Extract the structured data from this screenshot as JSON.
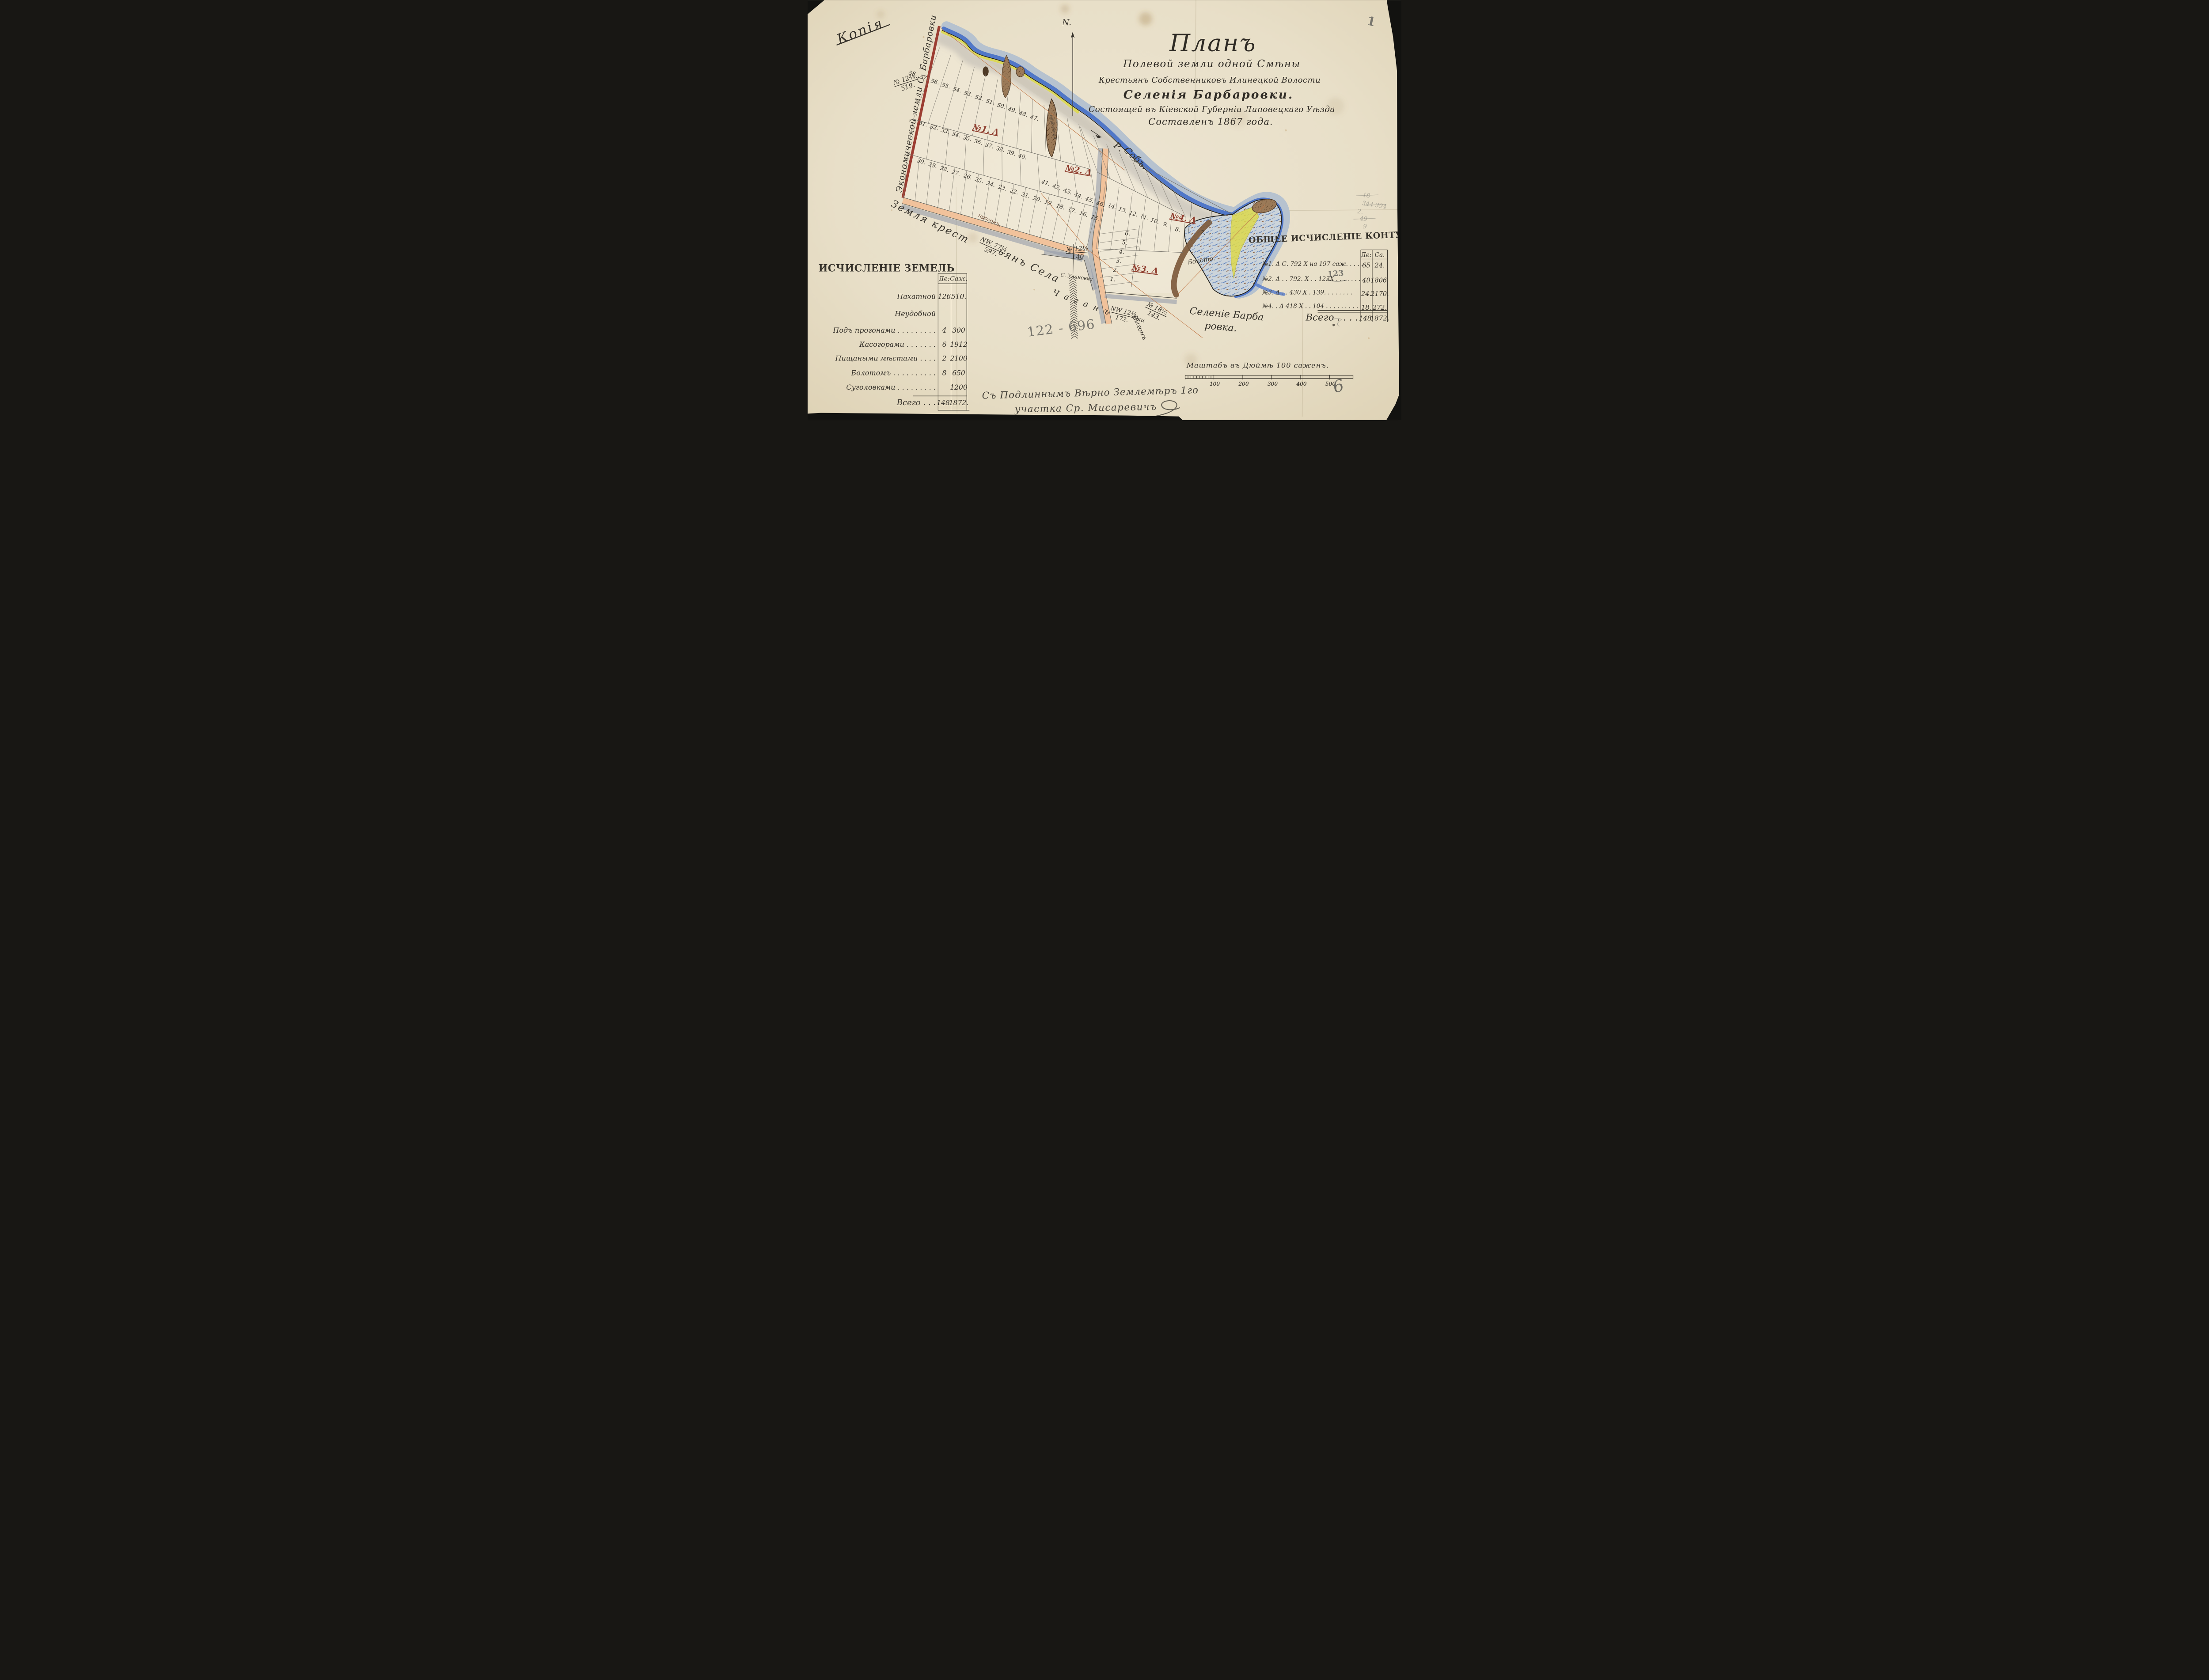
{
  "page": {
    "number": "1"
  },
  "stamp": {
    "copy": "Копія"
  },
  "compass": {
    "north": "N."
  },
  "title": {
    "line1": "Планъ",
    "line2": "Полевой земли одной Смѣны",
    "line3": "Крестьянъ Собственниковъ Илинецкой Волости",
    "line4": "Селенія Барбаровки.",
    "line5": "Состоящей въ Кіевской Губерніи Липовецкаго Уѣзда",
    "line6": "Составленъ 1867 года."
  },
  "map": {
    "section_labels": [
      "№1. Δ",
      "№2. Δ",
      "№3. Δ",
      "№4. Δ"
    ],
    "plot_rows": {
      "row_top": [
        "58.",
        "57.",
        "56.",
        "55.",
        "54.",
        "53.",
        "52.",
        "51.",
        "50.",
        "49.",
        "48.",
        "47."
      ],
      "row_mid": [
        "31.",
        "32.",
        "33.",
        "34.",
        "35.",
        "36.",
        "37.",
        "38.",
        "39.",
        "40."
      ],
      "row_bottom": [
        "30.",
        "29.",
        "28.",
        "27.",
        "26.",
        "25.",
        "24.",
        "23.",
        "22.",
        "21.",
        "20.",
        "19.",
        "18.",
        "17.",
        "16.",
        "15."
      ],
      "row_n2": [
        "41.",
        "42.",
        "43.",
        "44.",
        "45.",
        "46."
      ],
      "row_n2_lower": [
        "14.",
        "13.",
        "12.",
        "11.",
        "10.",
        "9."
      ],
      "row_n4": [
        "8.",
        "7."
      ],
      "col_n3": [
        "6.",
        "5.",
        "4.",
        "3.",
        "2.",
        "1."
      ]
    },
    "labels": {
      "river_r": "Р.",
      "river_sob": "Собъ.",
      "boloto": "Болото.",
      "village1": "Селеніе Барба",
      "village2": "ровка.",
      "vygon": "Выгонъ",
      "eco": "Экономической земли С. Барбаровки",
      "zem1": "Земля крест",
      "zem2": "ьянъ Села",
      "progon": "прогонъ.",
      "gully": "неудобная",
      "ulanovka": "С. Улановка",
      "chagan": "Чаганъ",
      "chagan_suffix": "Ски"
    },
    "fractions": {
      "no12_519": {
        "num": "№ 12¾.",
        "den": "519."
      },
      "no12_140": {
        "num": "№ 12½",
        "den": "140"
      },
      "nw77": {
        "num": "NW. 77¼",
        "den": "597."
      },
      "vygon18": {
        "num": "№ 18⅓",
        "den": "143."
      },
      "chagan": {
        "num": "NW 12¾",
        "den": "172."
      }
    }
  },
  "left_table": {
    "title": "ИСЧИСЛЕНІЕ ЗЕМЕЛЬ",
    "col_des": "Де:",
    "col_saj": "Саж.",
    "rows": [
      {
        "label": "Пахатной",
        "de": "126",
        "sa": "510."
      },
      {
        "label": "Неудобной",
        "de": "",
        "sa": ""
      },
      {
        "label": "Подъ прогонами . . . . . . . . .",
        "de": "4",
        "sa": "300"
      },
      {
        "label": "Касогорами . . . . . . .",
        "de": "6",
        "sa": "1912"
      },
      {
        "label": "Пищаными мѣстами . . . .",
        "de": "2",
        "sa": "2100"
      },
      {
        "label": "Болотомъ . . . . . . . . . .",
        "de": "8",
        "sa": "650"
      },
      {
        "label": "Суголовками . . . . . . . . .",
        "de": "",
        "sa": "1200"
      }
    ],
    "total": {
      "label": "Всего . . .",
      "de": "148.",
      "sa": "1872."
    }
  },
  "right_table": {
    "title": "ОБЩЕЕ ИСЧИСЛЕНІЕ КОНТУРЪ",
    "col_des": "Де:",
    "col_saj": "Са.",
    "rows": [
      {
        "label": "№1. Δ С. 792 Х на 197 саж. . . . . .",
        "de": "65",
        "sa": "24."
      },
      {
        "label": "№2. Δ . . 792. Х . . 123Х . . . . . . .",
        "de": "40",
        "sa": "1806."
      },
      {
        "label": "№3. Δ . . 430 Х . 139. . . . . . . .",
        "de": "24.",
        "sa": "2170."
      },
      {
        "label": "№4. . Δ 418 Х . . 104 . . . . . . . . .",
        "de": "18.",
        "sa": "272."
      }
    ],
    "total": {
      "label": "Всего . . . .",
      "de": "148.",
      "sa": "1872."
    },
    "pencil_correction": "123"
  },
  "scale": {
    "label": "Маштабъ въ Дюймѣ 100 саженъ.",
    "ticks": [
      "100",
      "200",
      "300",
      "400",
      "500"
    ],
    "flourish": "6"
  },
  "signature": {
    "line1": "Съ Подлиннымъ Вѣрно Землемѣръ 1го",
    "line2": "участка Ср. Мисаревичъ"
  },
  "pencil_notes": {
    "note_main": "122 - 696",
    "scribbles": [
      "18",
      "344 394",
      "2.",
      "49",
      "9"
    ]
  },
  "colors": {
    "paper": "#eae2cd",
    "ink": "#35312a",
    "red_label": "#8e3c2d",
    "boundary_red": "#9c3d32",
    "river_blue": "#5077c8",
    "river_shade": "#b6c2cf",
    "sand_yellow": "#ddd94e",
    "road_orange": "#f1c29b",
    "gully_brown": "#9b7a58",
    "pencil_gray": "#77756d"
  }
}
